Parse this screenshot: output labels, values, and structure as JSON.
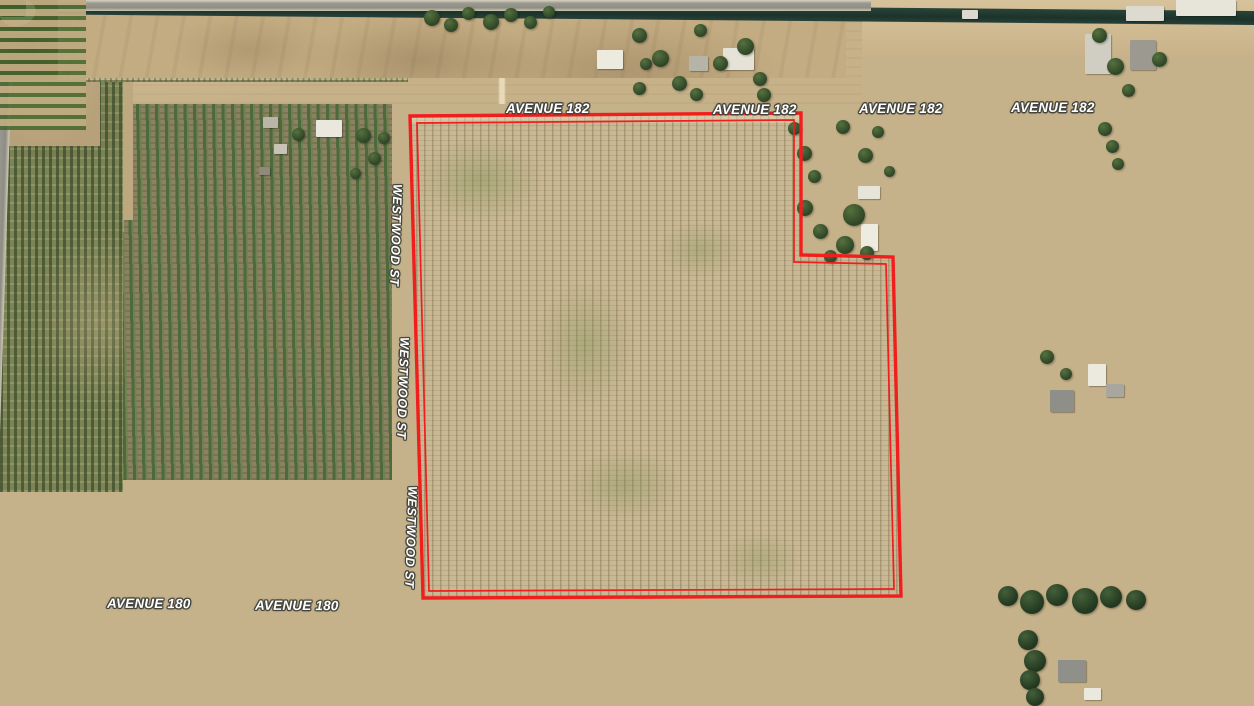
{
  "map": {
    "roads": {
      "avenue_182": {
        "label": "AVENUE 182",
        "label_count": 4
      },
      "westwood_st": {
        "label": "WESTWOOD ST",
        "label_count": 3
      },
      "avenue_180": {
        "label": "AVENUE 180",
        "label_count": 2
      }
    },
    "parcel_boundary": {
      "color": "#f21d1d",
      "style": "double-line"
    },
    "label_colors": {
      "text": "#ffffff",
      "outline": "#45453e"
    },
    "terrain_colors": {
      "parcel_field_tan": "#c8b893",
      "orchard_dark_green": "#30482a",
      "orchard_green": "#4e693c",
      "canal_water": "#223b30",
      "road_asphalt": "#94938a",
      "dirt": "#c4ac82",
      "pool_blue": "#3fb4d8"
    }
  }
}
